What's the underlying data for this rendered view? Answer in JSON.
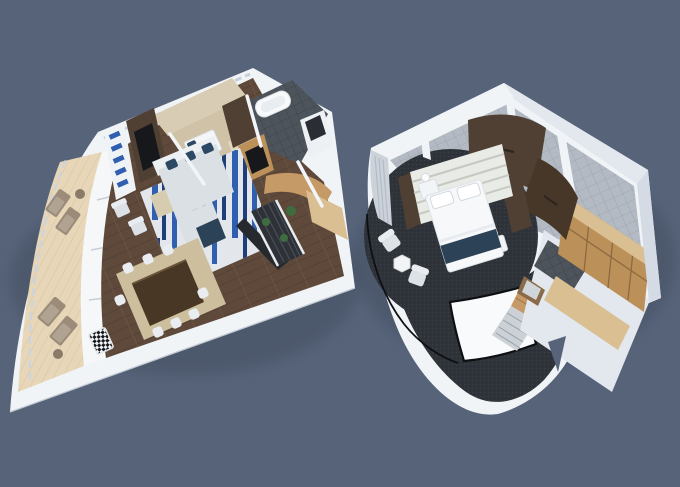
{
  "image": {
    "type": "3d-floorplan-render",
    "subject": "Aerial cutaway 3D floor plan of a two-level cruise-ship loft suite, two separate level plans side by side on a slate background",
    "text_content": "none"
  },
  "units": [
    {
      "label": "living-dining-level",
      "rooms": [
        "curved balcony with sun loungers and side tables",
        "living room with sectional sofa, blue accent rug and TV wall",
        "dining area with dark wood table and white chairs",
        "guest bedroom with beige carpet",
        "bathroom with tub and vanity",
        "staircase with planters and curved oak wall"
      ]
    },
    {
      "label": "master-bedroom-level",
      "rooms": [
        "round master bedroom with king bed and striped headboard",
        "dressing area with curved dark-wood wardrobe doors",
        "tiled bathroom area",
        "walk-in closet with oak shelving",
        "stair landing with black railing around open stairwell",
        "sitting spot with two white chairs and hexagon table"
      ]
    }
  ],
  "palette": {
    "background": "#566379",
    "wall": "#f1f4f7",
    "wall_shade": "#e3e8ef",
    "wall_dark": "#d5dbe4",
    "deck": "#e7d7b8",
    "deck_seam": "#d6c3a0",
    "floor": "#5e493b",
    "floor_seam": "#503d2f",
    "tile": "#b4bac3",
    "tile_grid": "#9aa1ac",
    "tile_dark": "#4e545c",
    "tile_dark_grid": "#3a4046",
    "carpet": "#2f343b",
    "carpet_fleck": "#3b4047",
    "rug": "#e3e7ec",
    "rug_blue": "#2f5fae",
    "rug_blue_dark": "#1e3f78",
    "sofa": "#dbe0e5",
    "sofa_light": "#edf0f3",
    "navy": "#2b4257",
    "pillow_navy": "#2c4863",
    "beige": "#cfc2a6",
    "corridor_beige": "#d8cdb4",
    "dining_rug": "#cdbf9e",
    "dining_table": "#483724",
    "chair": "#e9edf1",
    "oak": "#bb9059",
    "oak_light": "#d9bf92",
    "oak_curve": "#c59a66",
    "wood_dark": "#4f4033",
    "tv": "#16181c",
    "lounger": "#9b8b78",
    "lounger_cushion": "#b0a392",
    "curtain": "#ccd2d9",
    "curtain_pleat": "#b4bbc5",
    "headboard": "#e9ebe7",
    "headboard_line": "#c6c9c1",
    "railing": "#0e0f11",
    "step": "#ccd1d7",
    "step_line": "#9aa0a8",
    "plant": "#3f6d3f"
  }
}
